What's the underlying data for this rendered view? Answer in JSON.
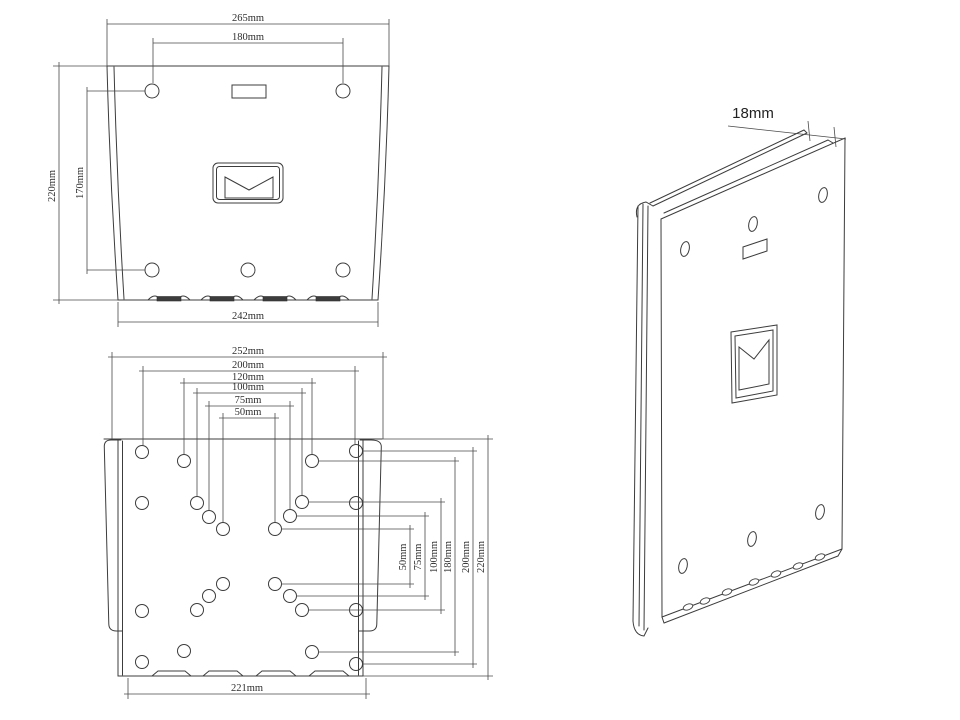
{
  "colors": {
    "background": "#ffffff",
    "line": "#3c3c3c",
    "text": "#2e2e2e"
  },
  "wall_plate_view": {
    "dim_width_top": "265mm",
    "dim_hole_spacing_top": "180mm",
    "dim_height_left": "220mm",
    "dim_hole_spacing_left": "170mm",
    "dim_width_bottom": "242mm"
  },
  "vesa_plate_view": {
    "dims_top": [
      "252mm",
      "200mm",
      "120mm",
      "100mm",
      "75mm",
      "50mm"
    ],
    "dims_right": [
      "50mm",
      "75mm",
      "100mm",
      "180mm",
      "200mm",
      "220mm"
    ],
    "dim_width_bottom": "221mm"
  },
  "side_view": {
    "dim_thickness": "18mm"
  }
}
